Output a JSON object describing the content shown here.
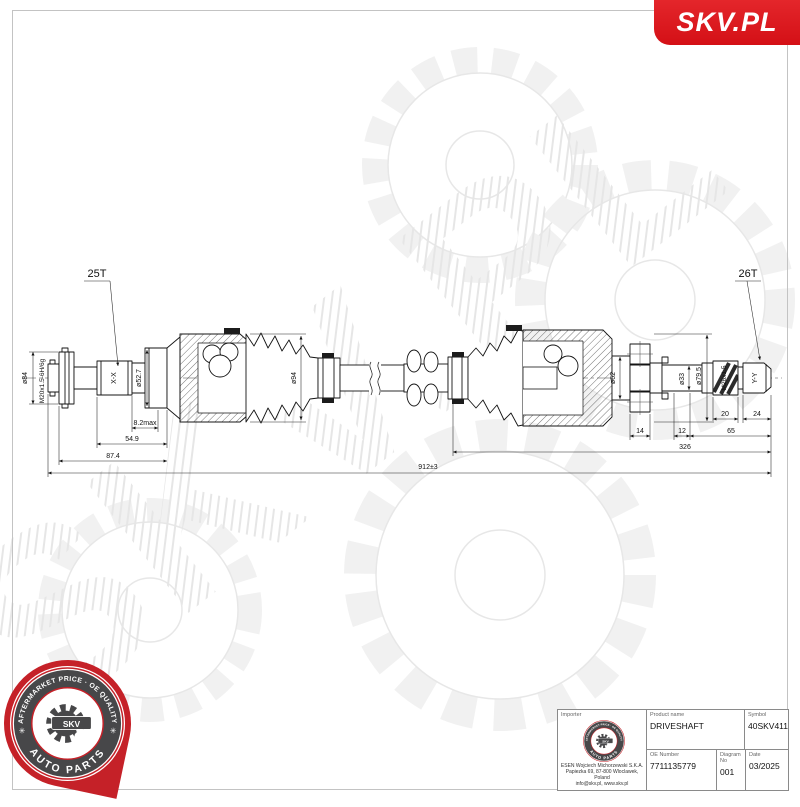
{
  "brand": {
    "logo_text": "SKV.PL"
  },
  "watermark": {
    "text": "SKV.PL"
  },
  "colors": {
    "brand_red": "#e30613",
    "pin_red": "#c52128",
    "badge_gray": "#474749"
  },
  "badge": {
    "arc_top": "AFTERMARKET PRICE · OE QUALITY",
    "arc_bottom": "AUTO PARTS",
    "center": "SKV",
    "star": "✳"
  },
  "drawing": {
    "teeth_left": "25T",
    "teeth_right": "26T",
    "dia_flange_left": "ø84",
    "thread_left": "M20x1.5-6H/6g",
    "section_left": "X-X",
    "dia_left_shaft": "ø52.7",
    "dia_left_boot": "ø94",
    "dia_right_neck": "ø62",
    "dia_right_shaft": "ø33",
    "dia_right_flange": "ø79.5",
    "thread_right": "M26x1.5",
    "section_right": "Y-Y",
    "dim_spline_offset": "8.2max",
    "dim_spline_len": "54.9",
    "dim_left_end": "87.4",
    "dim_ring_width": "14",
    "dim_groove": "12",
    "dim_right_end": "65",
    "dim_thread_len": "20",
    "dim_spline_right": "24",
    "dim_inner_section": "326",
    "dim_overall": "912±3"
  },
  "title_block": {
    "importer_label": "Importer",
    "importer_name": "ESEN Wojciech Michorzewski S.K.A.",
    "importer_address": "Papiezka 69, 87-800 Wloclawek, Poland",
    "importer_contact": "info@skv.pl, www.skv.pl",
    "product_name_label": "Product name",
    "product_name": "DRIVESHAFT",
    "symbol_label": "Symbol",
    "symbol": "40SKV411",
    "oe_number_label": "OE Number",
    "oe_number": "7711135779",
    "diagram_no_label": "Diagram No",
    "diagram_no": "001",
    "date_label": "Date",
    "date": "03/2025"
  }
}
